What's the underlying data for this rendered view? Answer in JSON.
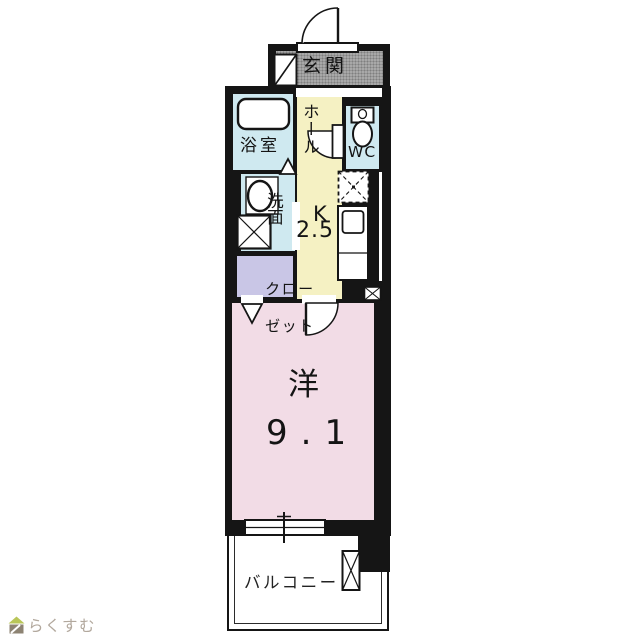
{
  "meta": {
    "type": "real-estate floor plan (madori-zu)",
    "logo_text": "らくすむ"
  },
  "colors": {
    "wall": "#151515",
    "wet_area_cyan": "#cfe9f0",
    "hall_kitchen_yellow": "#f5f1c3",
    "closet_lavender": "#c9c6e6",
    "room_pink": "#f2dce6",
    "genkan_gray": "#a8a8a8",
    "logo_roof_green": "#b9c659",
    "logo_body_brown": "#8d8373",
    "logo_text_gray": "#b2a89d"
  },
  "rooms": {
    "genkan": {
      "label": "玄関"
    },
    "bath": {
      "label": "浴室"
    },
    "hall": {
      "label": "ホール"
    },
    "wc": {
      "label": "WC"
    },
    "washroom": {
      "label": "洗面"
    },
    "kitchen": {
      "label": "K",
      "size": "2.5"
    },
    "closet": {
      "label_line1": "クロー",
      "label_line2": "ゼット",
      "label_full": "クローゼット"
    },
    "main_room": {
      "label": "洋",
      "size": "9.1"
    },
    "balcony": {
      "label": "バルコニー"
    }
  },
  "icons": [
    "entrance-door-swing-icon",
    "shoe-cabinet-icon",
    "bathtub-icon",
    "bath-fold-door-icon",
    "sink-icon",
    "washer-placement-icon",
    "wc-door-swing-icon",
    "toilet-icon",
    "refrigerator-placement-icon",
    "kitchen-counter-icon",
    "pipe-space-icon",
    "closet-fold-door-icon",
    "room-door-swing-icon",
    "window-icon",
    "balcony-partition-icon",
    "house-logo-icon"
  ]
}
